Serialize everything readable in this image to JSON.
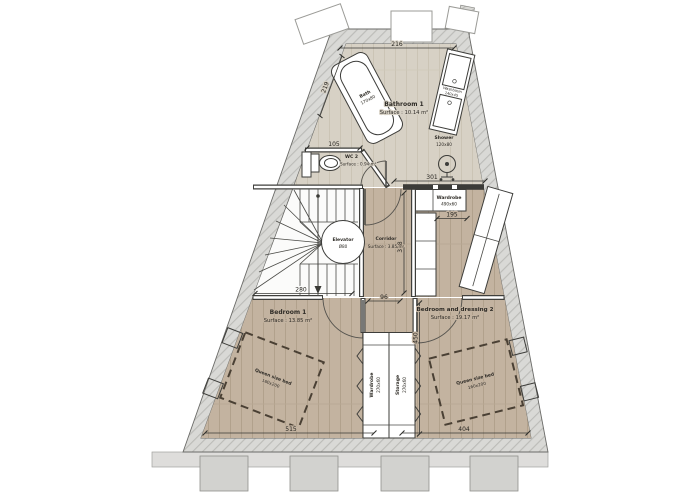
{
  "plan": {
    "rooms": {
      "bathroom1": {
        "name": "Bathroom 1",
        "surface": "Surface : 10.14 m²"
      },
      "wc2": {
        "name": "WC 2",
        "surface": "Surface : 0.94 m²"
      },
      "corridor": {
        "name": "Corridor",
        "surface": "Surface : 3.85 m²"
      },
      "bedroom1": {
        "name": "Bedroom 1",
        "surface": "Surface : 13.85 m²"
      },
      "bedroom2": {
        "name": "Bedroom and dressing 2",
        "surface": "Surface : 19.17 m²"
      }
    },
    "furniture": {
      "bath": {
        "name": "Bath",
        "size": "170x80"
      },
      "shower": {
        "name": "Shower",
        "size": "120x80"
      },
      "washbasin": {
        "name": "Washbasin",
        "size": "140x45"
      },
      "elevator": {
        "name": "Elevator",
        "size": "Ø80"
      },
      "wardrobe_unit": {
        "name": "Wardrobe",
        "size": "490x60"
      },
      "bed1": {
        "name": "Queen size bed",
        "size": "160x200"
      },
      "bed2": {
        "name": "Queen size bed",
        "size": "160x200"
      },
      "strip_wardrobe": {
        "name": "Wardrobe",
        "size": "270x60"
      },
      "strip_storage": {
        "name": "Storage",
        "size": "270x60"
      }
    },
    "dimensions": {
      "top_width": "216",
      "bath_side": "219",
      "wc_width": "105",
      "wardrobe_width": "301",
      "closet_width": "195",
      "corridor_length": "318",
      "bedroom1_width": "280",
      "bedroom2_length": "450",
      "bottom_left_width": "515",
      "bottom_right_width": "404",
      "corridor_width": "96"
    },
    "colors": {
      "wall_fill": "#d9d9d6",
      "floor_light": "#d7d1c5",
      "floor_wood": "#c3b3a0",
      "line": "#3f3f3c"
    }
  }
}
